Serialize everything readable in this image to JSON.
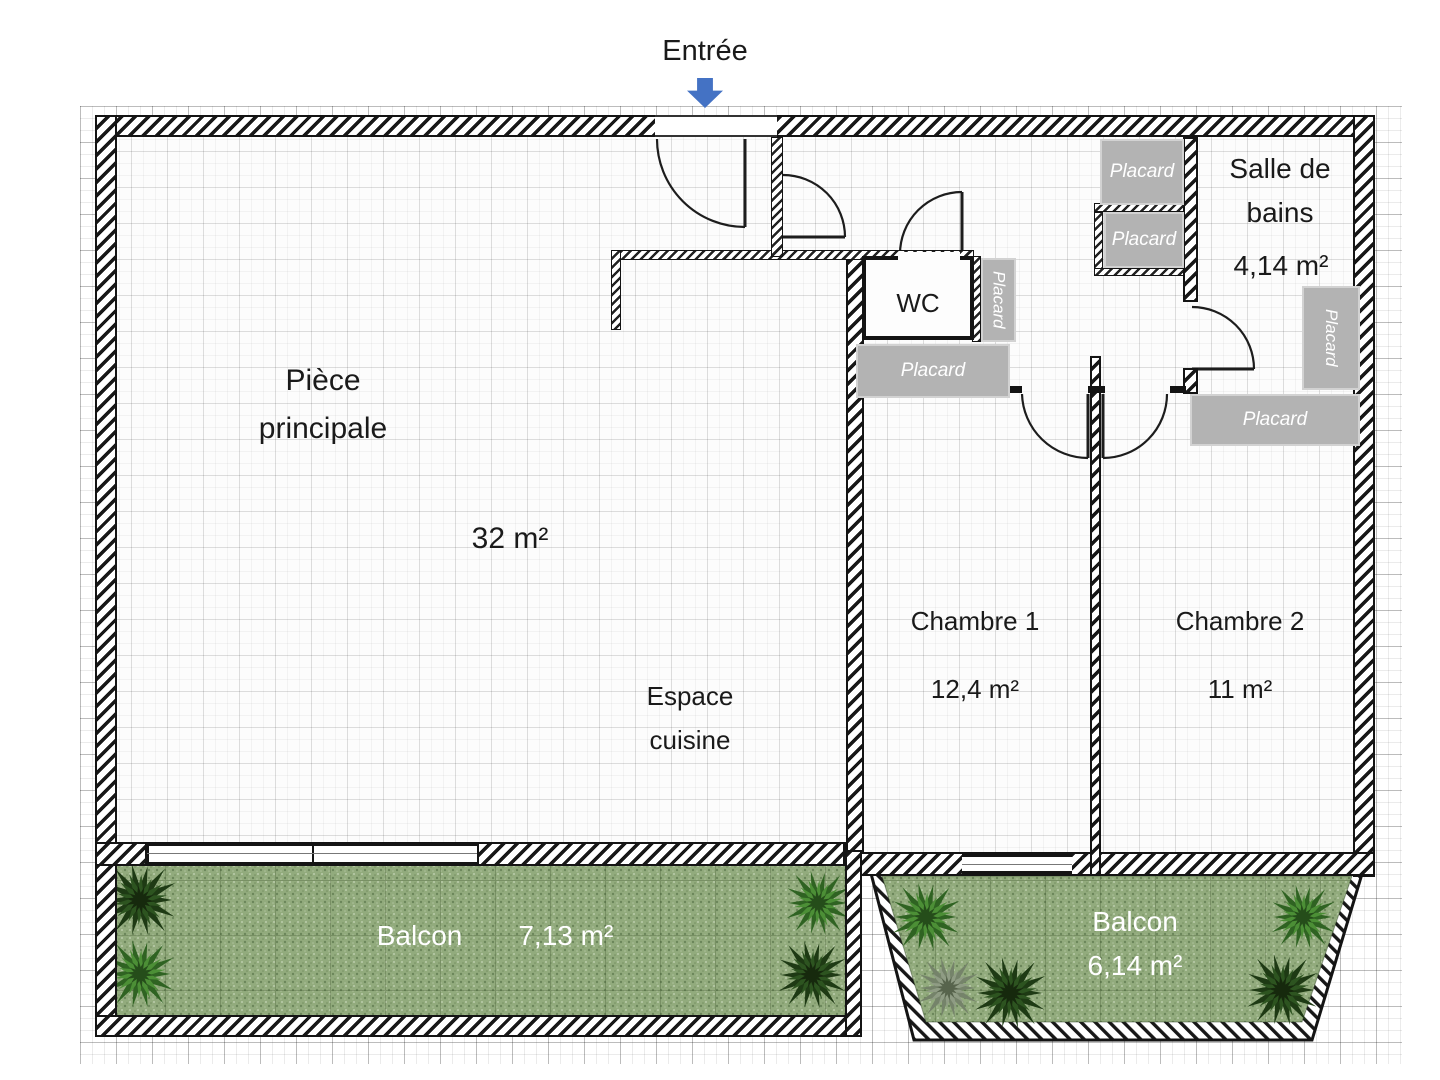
{
  "plan": {
    "entrance_label": "Entrée",
    "rooms": {
      "main": {
        "name": "Pièce principale",
        "area": "32 m²"
      },
      "kitchen": {
        "name": "Espace cuisine"
      },
      "wc": {
        "name": "WC"
      },
      "bedroom1": {
        "name": "Chambre 1",
        "area": "12,4 m²"
      },
      "bedroom2": {
        "name": "Chambre 2",
        "area": "11 m²"
      },
      "bathroom": {
        "name": "Salle de bains",
        "area": "4,14 m²"
      },
      "balcony_main": {
        "name": "Balcon",
        "area": "7,13 m²"
      },
      "balcony_bedrooms": {
        "name": "Balcon",
        "area": "6,14 m²"
      }
    },
    "closet_label": "Placard",
    "closet_count": 6,
    "colors": {
      "entrance_arrow": "#4472C4",
      "closet_fill": "#b3b3b3",
      "grass": "#92ab7d",
      "wall": "#141414"
    }
  }
}
